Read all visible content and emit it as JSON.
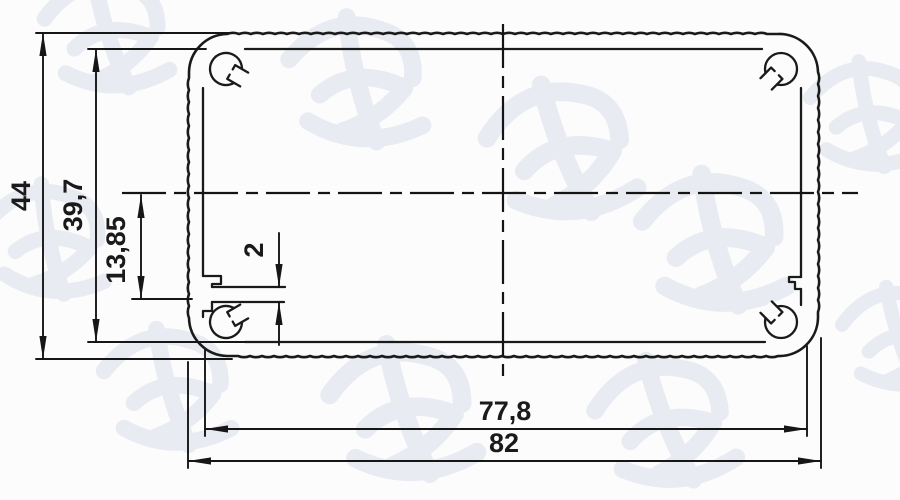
{
  "drawing": {
    "watermark_text": "鸿发顺达",
    "colors": {
      "line": "#1a1a1a",
      "watermark": "#e8ebf2",
      "background": "#fcfcfd"
    },
    "dimensions": {
      "overall_height": "44",
      "inner_height": "39,7",
      "rib_offset_from_center": "13,85",
      "rib_thickness": "2",
      "inner_width": "77,8",
      "overall_width": "82"
    }
  }
}
